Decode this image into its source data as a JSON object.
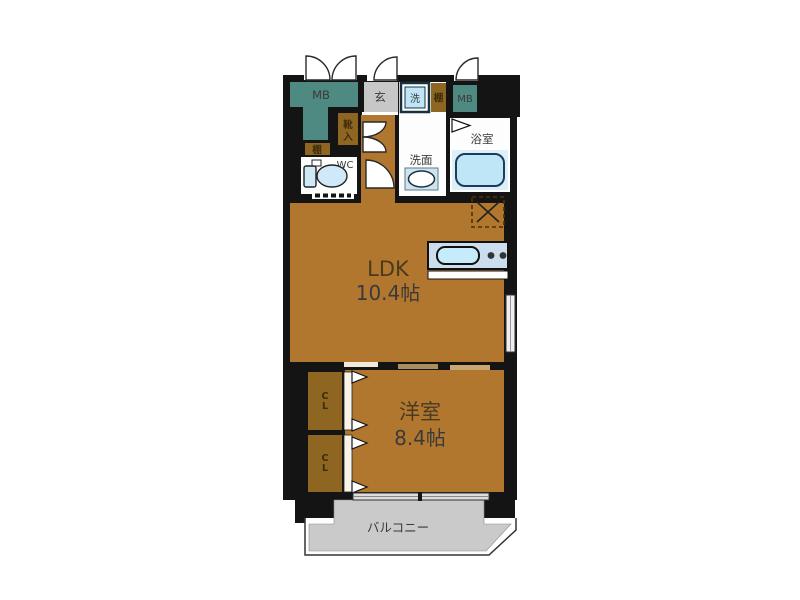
{
  "plan_title": "apartment-floor-plan",
  "labels": {
    "mb_left": "MB",
    "mb_right": "MB",
    "entrance": "玄",
    "washer": "洗",
    "shelf_top": "棚",
    "shelf_left": "棚",
    "shoe_cabinet": [
      "靴",
      "入"
    ],
    "toilet": "WC",
    "washroom": "洗面",
    "bathroom": "浴室",
    "ldk_name": "LDK",
    "ldk_size": "10.4帖",
    "western_name": "洋室",
    "western_size": "8.4帖",
    "closet1": [
      "C",
      "L"
    ],
    "closet2": [
      "C",
      "L"
    ],
    "balcony": "バルコニー"
  },
  "rooms": [
    {
      "name": "LDK",
      "size": "10.4帖"
    },
    {
      "name": "洋室",
      "size": "8.4帖"
    },
    {
      "name": "浴室"
    },
    {
      "name": "洗面"
    },
    {
      "name": "WC"
    },
    {
      "name": "玄"
    },
    {
      "name": "バルコニー"
    },
    {
      "name": "MB"
    },
    {
      "name": "CL"
    }
  ],
  "symbols": [
    "bathtub",
    "toilet",
    "washbasin",
    "washing-machine-pan",
    "kitchen-counter-sink",
    "stove-dots",
    "refrigerator-space-dashed-x",
    "swing-door-arcs",
    "sliding-door-triangles",
    "window-lines",
    "balcony-railing"
  ],
  "colors": {
    "wall_black": "#141414",
    "room_brown": "#b2772f",
    "cabinet_brown": "#8e6521",
    "meter_box_teal": "#4e8a81",
    "entry_gray": "#c7c7c7",
    "balcony_gray": "#cacaca",
    "fixture_blue": "#c0e7f7",
    "counter_blue_gray": "#ccdeee",
    "background": "#ffffff"
  }
}
